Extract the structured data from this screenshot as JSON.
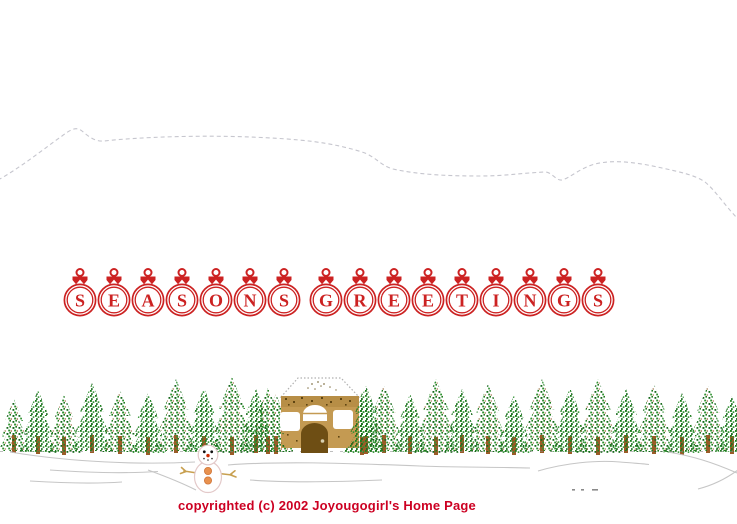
{
  "page": {
    "background": "#ffffff",
    "title": "Seasons Greetings holiday home page"
  },
  "greeting": {
    "text": "SEASONS GREETINGS",
    "words": [
      [
        "S",
        "E",
        "A",
        "S",
        "O",
        "N",
        "S"
      ],
      [
        "G",
        "R",
        "E",
        "E",
        "T",
        "I",
        "N",
        "G",
        "S"
      ]
    ],
    "ornament_color": "#cc2222"
  },
  "footer": {
    "copyright": "copyrighted (c) 2002 Joyougogirl's Home Page",
    "color": "#cc0022"
  },
  "scene": {
    "elements": [
      "mountain-outline",
      "evergreen-tree-row",
      "snow-cabin",
      "snowman",
      "snow-drifts",
      "ground-marks"
    ],
    "colors": {
      "tree_green_dark": "#17691c",
      "tree_green": "#1e7d1e",
      "tree_green_light": "#2e9230",
      "branch_brown": "#8a5a26",
      "trunk_brown": "#9a5c28",
      "cabin_wall": "#c49a52",
      "cabin_wall_band": "#b78e46",
      "cabin_door": "#6e4e14",
      "cabin_knob": "#d8d0b0",
      "cabin_speckle": "#5f4512",
      "roof_outline": "#b0b0b0",
      "ridge_dot": "#8a7a50",
      "snow_line": "#c6c6c6",
      "mountain_line": "#b8b8c2",
      "snowman_outline": "#e3c9c9",
      "snowman_button": "#e8914e",
      "snowman_button_edge": "#d0763a",
      "snowman_nose": "#cc2a00",
      "stick_tan": "#c8a050",
      "ground_mark": "#8a8a8a"
    }
  }
}
